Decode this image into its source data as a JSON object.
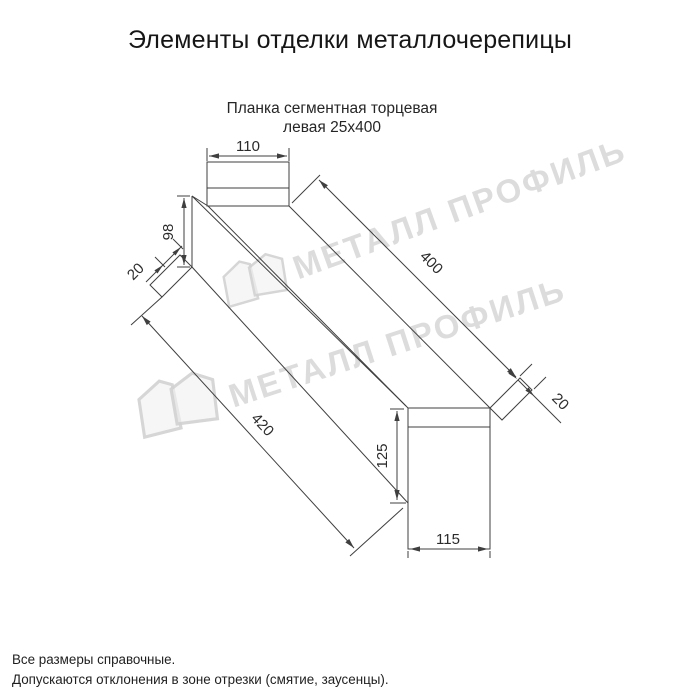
{
  "page": {
    "title": "Элементы отделки металлочерепицы"
  },
  "drawing": {
    "subtitle": {
      "line1": "Планка сегментная торцевая",
      "line2": "левая 25х400"
    },
    "dims": {
      "top_width": "110",
      "left_web_height": "98",
      "left_hem": "20",
      "top_edge_length": "400",
      "bottom_edge_length": "420",
      "right_hem": "20",
      "right_web_height": "125",
      "bottom_width": "115"
    },
    "line_color": "#3f3f3f"
  },
  "watermark": {
    "brand": "МЕТАЛЛ ПРОФИЛЬ",
    "color": "#d7d7d7"
  },
  "footer": {
    "note1": "Все размеры справочные.",
    "note2": "Допускаются отклонения в зоне отрезки (смятие, заусенцы)."
  }
}
